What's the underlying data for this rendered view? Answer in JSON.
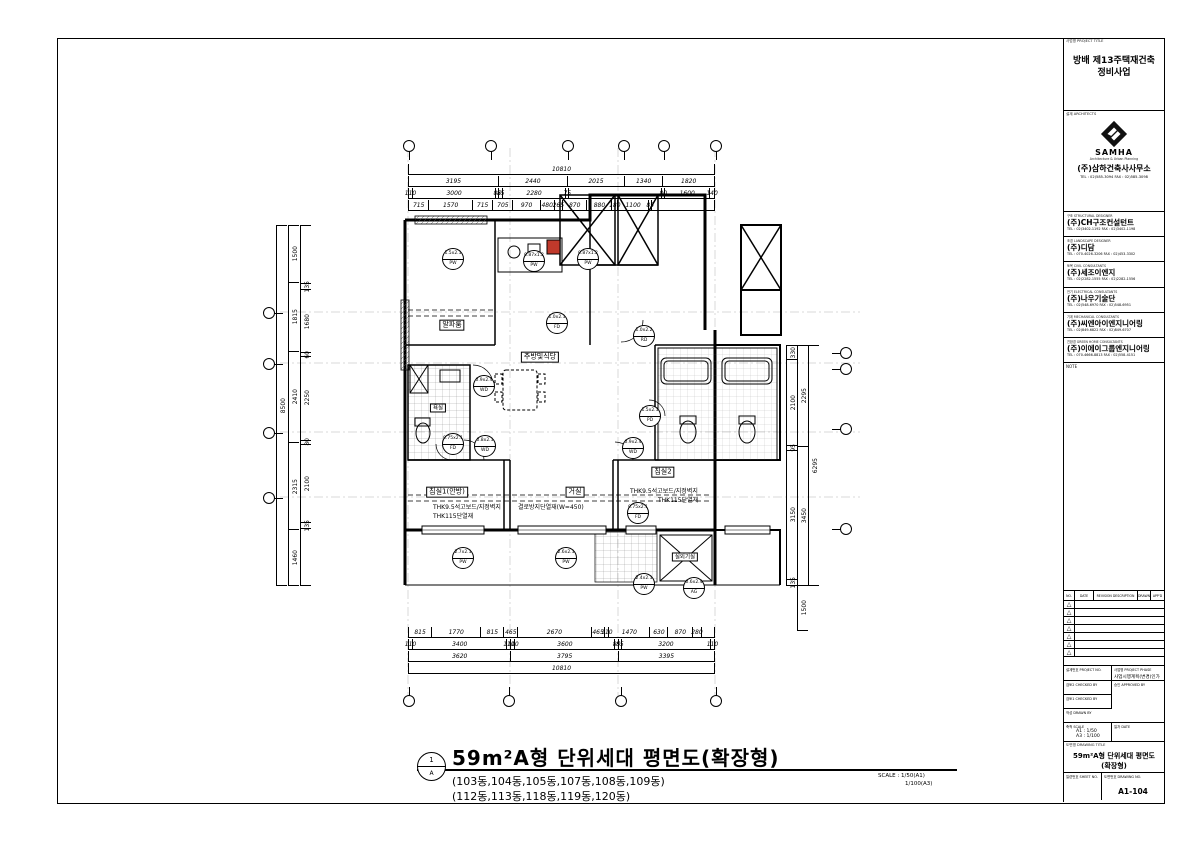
{
  "sheet": {
    "project_title_header": "사업명 PROJECT TITLE",
    "project_title_line1": "방배 제13주택재건축",
    "project_title_line2": "정비사업",
    "architects": {
      "header": "설계 ARCHITECTS",
      "logo_text": "SAMHA",
      "logo_tagline": "Architecture & Urban Planning",
      "company": "(주)삼하건축사사무소",
      "tel": "TEL : 02)585-3094    FAX : 02)585-3098"
    },
    "consultants": [
      {
        "role": "구조 STRUCTURAL DESIGNER",
        "name": "(주)CH구조컨설턴트",
        "tel": "TEL : 02)3402-1192    FAX : 02)3402-1198"
      },
      {
        "role": "조경 LANDSCAPE DESIGNER",
        "name": "(주)디담",
        "tel": "TEL : 070-4026-3206    FAX : 02)453-3302"
      },
      {
        "role": "토목 CIVIL CONSULTANTS",
        "name": "(주)세조이엔지",
        "tel": "TEL : 02)2282-1555    FAX : 02)2282-1556"
      },
      {
        "role": "전기 ELECTRICAL CONSULTANTS",
        "name": "(주)나우기술단",
        "tel": "TEL : 02)548-6970    FAX : 02)548-6951"
      },
      {
        "role": "기계 MECHANICAL CONSULTANTS",
        "name": "(주)씨엔아이엔지니어링",
        "tel": "TEL : 02)849-6822    FAX : 02)849-6707"
      },
      {
        "role": "친환경 GREEN HOME CONSULTANTS",
        "name": "(주)이에이그룹엔지니어링",
        "tel": "TEL : 070-4666-8813    FAX : 02)558-4151"
      }
    ],
    "note_label": "NOTE",
    "revision": {
      "headers": {
        "no": "NO.",
        "date": "DATE",
        "desc": "REVISION DESCRIPTION",
        "drawn": "DRAWN",
        "appd": "APP'D"
      },
      "rows": [
        "△",
        "△",
        "△",
        "△",
        "△",
        "△",
        "△"
      ]
    },
    "info": {
      "project_no_label": "설계번호 PROJECT NO.",
      "phase_label": "사업명 PROJECT PHASE",
      "phase_value": "사업시행계획(변경)인가",
      "checked2_label": "검토2 CHECKED BY",
      "approved_label": "승인 APPROVED BY",
      "checked1_label": "검토1 CHECKED BY",
      "drawn_label": "작성 DRAWN BY",
      "scale_label": "축척 SCALE",
      "scale_a1": "A1 : 1/50",
      "scale_a3": "A3 : 1/100",
      "date_label": "일자 DATE",
      "title_label": "도면명 DRAWING TITLE",
      "title_line1": "59m²A형 단위세대 평면도",
      "title_line2": "(확장형)",
      "sheet_no_label": "일련번호 SHEET NO.",
      "dwg_no_label": "도면번호 DRAWING NO.",
      "dwg_no": "A1-104"
    }
  },
  "drawing_title": {
    "sym_num": "1",
    "sym_letter": "A",
    "title": "59m²A형 단위세대 평면도(확장형)",
    "sub1": "(103동,104동,105동,107동,108동,109동)",
    "sub2": "(112동,113동,118동,119동,120동)",
    "scale1": "SCALE : 1/50(A1)",
    "scale2": "1/100(A3)"
  },
  "plan": {
    "accent_red": "#c0392b",
    "rooms": {
      "alpha": "알파룸",
      "kitchen": "주방및식당",
      "bed1": "침실1(안방)",
      "living": "거실",
      "bed2": "침실2",
      "bath": "욕실",
      "ac": "실외기실"
    },
    "annotations": {
      "a1": "THK9.5석고보드/지정벽지",
      "a2": "THK115단열재",
      "a3": "결로방지단열재(W=450)",
      "a4": "THK9.5석고보드/지정벽지",
      "a5": "THK115단열재"
    },
    "tags": [
      {
        "size": "1.5x2.1",
        "code": "PW"
      },
      {
        "size": "0.87x1.2",
        "code": "PW"
      },
      {
        "size": "0.87x1.2",
        "code": "PW"
      },
      {
        "size": "1.0x2.2",
        "code": "RD"
      },
      {
        "size": "1.0x2.1",
        "code": "FD"
      },
      {
        "size": "0.9x2.4",
        "code": "WD"
      },
      {
        "size": "0.8x2.1",
        "code": "WD"
      },
      {
        "size": "0.75x2.1",
        "code": "FD"
      },
      {
        "size": "1.5x2.1",
        "code": "PD"
      },
      {
        "size": "0.9x2.4",
        "code": "WD"
      },
      {
        "size": "2.7x2.1",
        "code": "PW"
      },
      {
        "size": "2.6x2.1",
        "code": "PW"
      },
      {
        "size": "2.4x2.1",
        "code": "PW"
      },
      {
        "size": "0.6x2.4",
        "code": "AG"
      },
      {
        "size": "0.75x2.1",
        "code": "FD"
      }
    ],
    "dims": {
      "top": {
        "row1": [
          {
            "t": "10810",
            "w": 10810
          }
        ],
        "row2": [
          {
            "t": "3195",
            "w": 3195
          },
          {
            "t": "2440",
            "w": 2440
          },
          {
            "t": "2015",
            "w": 2015
          },
          {
            "t": "1340",
            "w": 1340
          },
          {
            "t": "1820",
            "w": 1820
          }
        ],
        "row3": [
          {
            "t": "110",
            "w": 110
          },
          {
            "t": "3000",
            "w": 3000
          },
          {
            "t": "85",
            "w": 85
          },
          {
            "t": "85",
            "w": 85
          },
          {
            "t": "2280",
            "w": 2280
          },
          {
            "t": "75",
            "w": 75
          },
          {
            "t": "",
            "w": 3355
          },
          {
            "t": "80",
            "w": 80
          },
          {
            "t": "1600",
            "w": 1600
          },
          {
            "t": "140",
            "w": 140
          }
        ],
        "row4": [
          {
            "t": "715",
            "w": 715
          },
          {
            "t": "1570",
            "w": 1570
          },
          {
            "t": "715",
            "w": 715
          },
          {
            "t": "705",
            "w": 705
          },
          {
            "t": "970",
            "w": 970
          },
          {
            "t": "480",
            "w": 480
          },
          {
            "t": "265",
            "w": 265
          },
          {
            "t": "870",
            "w": 870
          },
          {
            "t": "880",
            "w": 880
          },
          {
            "t": "180",
            "w": 180
          },
          {
            "t": "1100",
            "w": 1100
          },
          {
            "t": "85",
            "w": 85
          },
          {
            "t": "",
            "w": 2275
          }
        ]
      },
      "bottom": {
        "row1": [
          {
            "t": "815",
            "w": 815
          },
          {
            "t": "1770",
            "w": 1770
          },
          {
            "t": "815",
            "w": 815
          },
          {
            "t": "465",
            "w": 465
          },
          {
            "t": "2670",
            "w": 2670
          },
          {
            "t": "465",
            "w": 465
          },
          {
            "t": "110",
            "w": 110
          },
          {
            "t": "1470",
            "w": 1470
          },
          {
            "t": "630",
            "w": 630
          },
          {
            "t": "870",
            "w": 870
          },
          {
            "t": "280",
            "w": 280
          },
          {
            "t": "",
            "w": 450
          }
        ],
        "row2": [
          {
            "t": "110",
            "w": 110
          },
          {
            "t": "3400",
            "w": 3400
          },
          {
            "t": "110",
            "w": 110
          },
          {
            "t": "110",
            "w": 110
          },
          {
            "t": "3600",
            "w": 3600
          },
          {
            "t": "85",
            "w": 85
          },
          {
            "t": "85",
            "w": 85
          },
          {
            "t": "3200",
            "w": 3200
          },
          {
            "t": "110",
            "w": 110
          }
        ],
        "row3": [
          {
            "t": "3620",
            "w": 3620
          },
          {
            "t": "3795",
            "w": 3795
          },
          {
            "t": "3395",
            "w": 3395
          }
        ],
        "row4": [
          {
            "t": "10810",
            "w": 10810
          }
        ]
      },
      "left": {
        "colA": [
          {
            "t": "8500",
            "w": 9500
          }
        ],
        "colB": [
          {
            "t": "1500",
            "w": 1500
          },
          {
            "t": "1815",
            "w": 1815
          },
          {
            "t": "2410",
            "w": 2410
          },
          {
            "t": "2315",
            "w": 2315
          },
          {
            "t": "1460",
            "w": 1460
          }
        ],
        "colC": [
          {
            "t": "",
            "w": 1550
          },
          {
            "t": "135",
            "w": 135
          },
          {
            "t": "1680",
            "w": 1680
          },
          {
            "t": "60",
            "w": 60
          },
          {
            "t": "2250",
            "w": 2250
          },
          {
            "t": "80",
            "w": 80
          },
          {
            "t": "2100",
            "w": 2100
          },
          {
            "t": "135",
            "w": 135
          },
          {
            "t": "",
            "w": 1510
          }
        ]
      },
      "right": {
        "colA": [
          {
            "t": "330",
            "w": 330
          },
          {
            "t": "2100",
            "w": 2100
          },
          {
            "t": "95",
            "w": 95
          },
          {
            "t": "3150",
            "w": 3150
          },
          {
            "t": "135",
            "w": 135
          }
        ],
        "colB": [
          {
            "t": "2295",
            "w": 2430
          },
          {
            "t": "3450",
            "w": 3380
          }
        ],
        "colC": [
          {
            "t": "6295",
            "w": 5810
          }
        ],
        "colD": [
          {
            "t": "1500",
            "w": 1500
          }
        ]
      }
    }
  }
}
